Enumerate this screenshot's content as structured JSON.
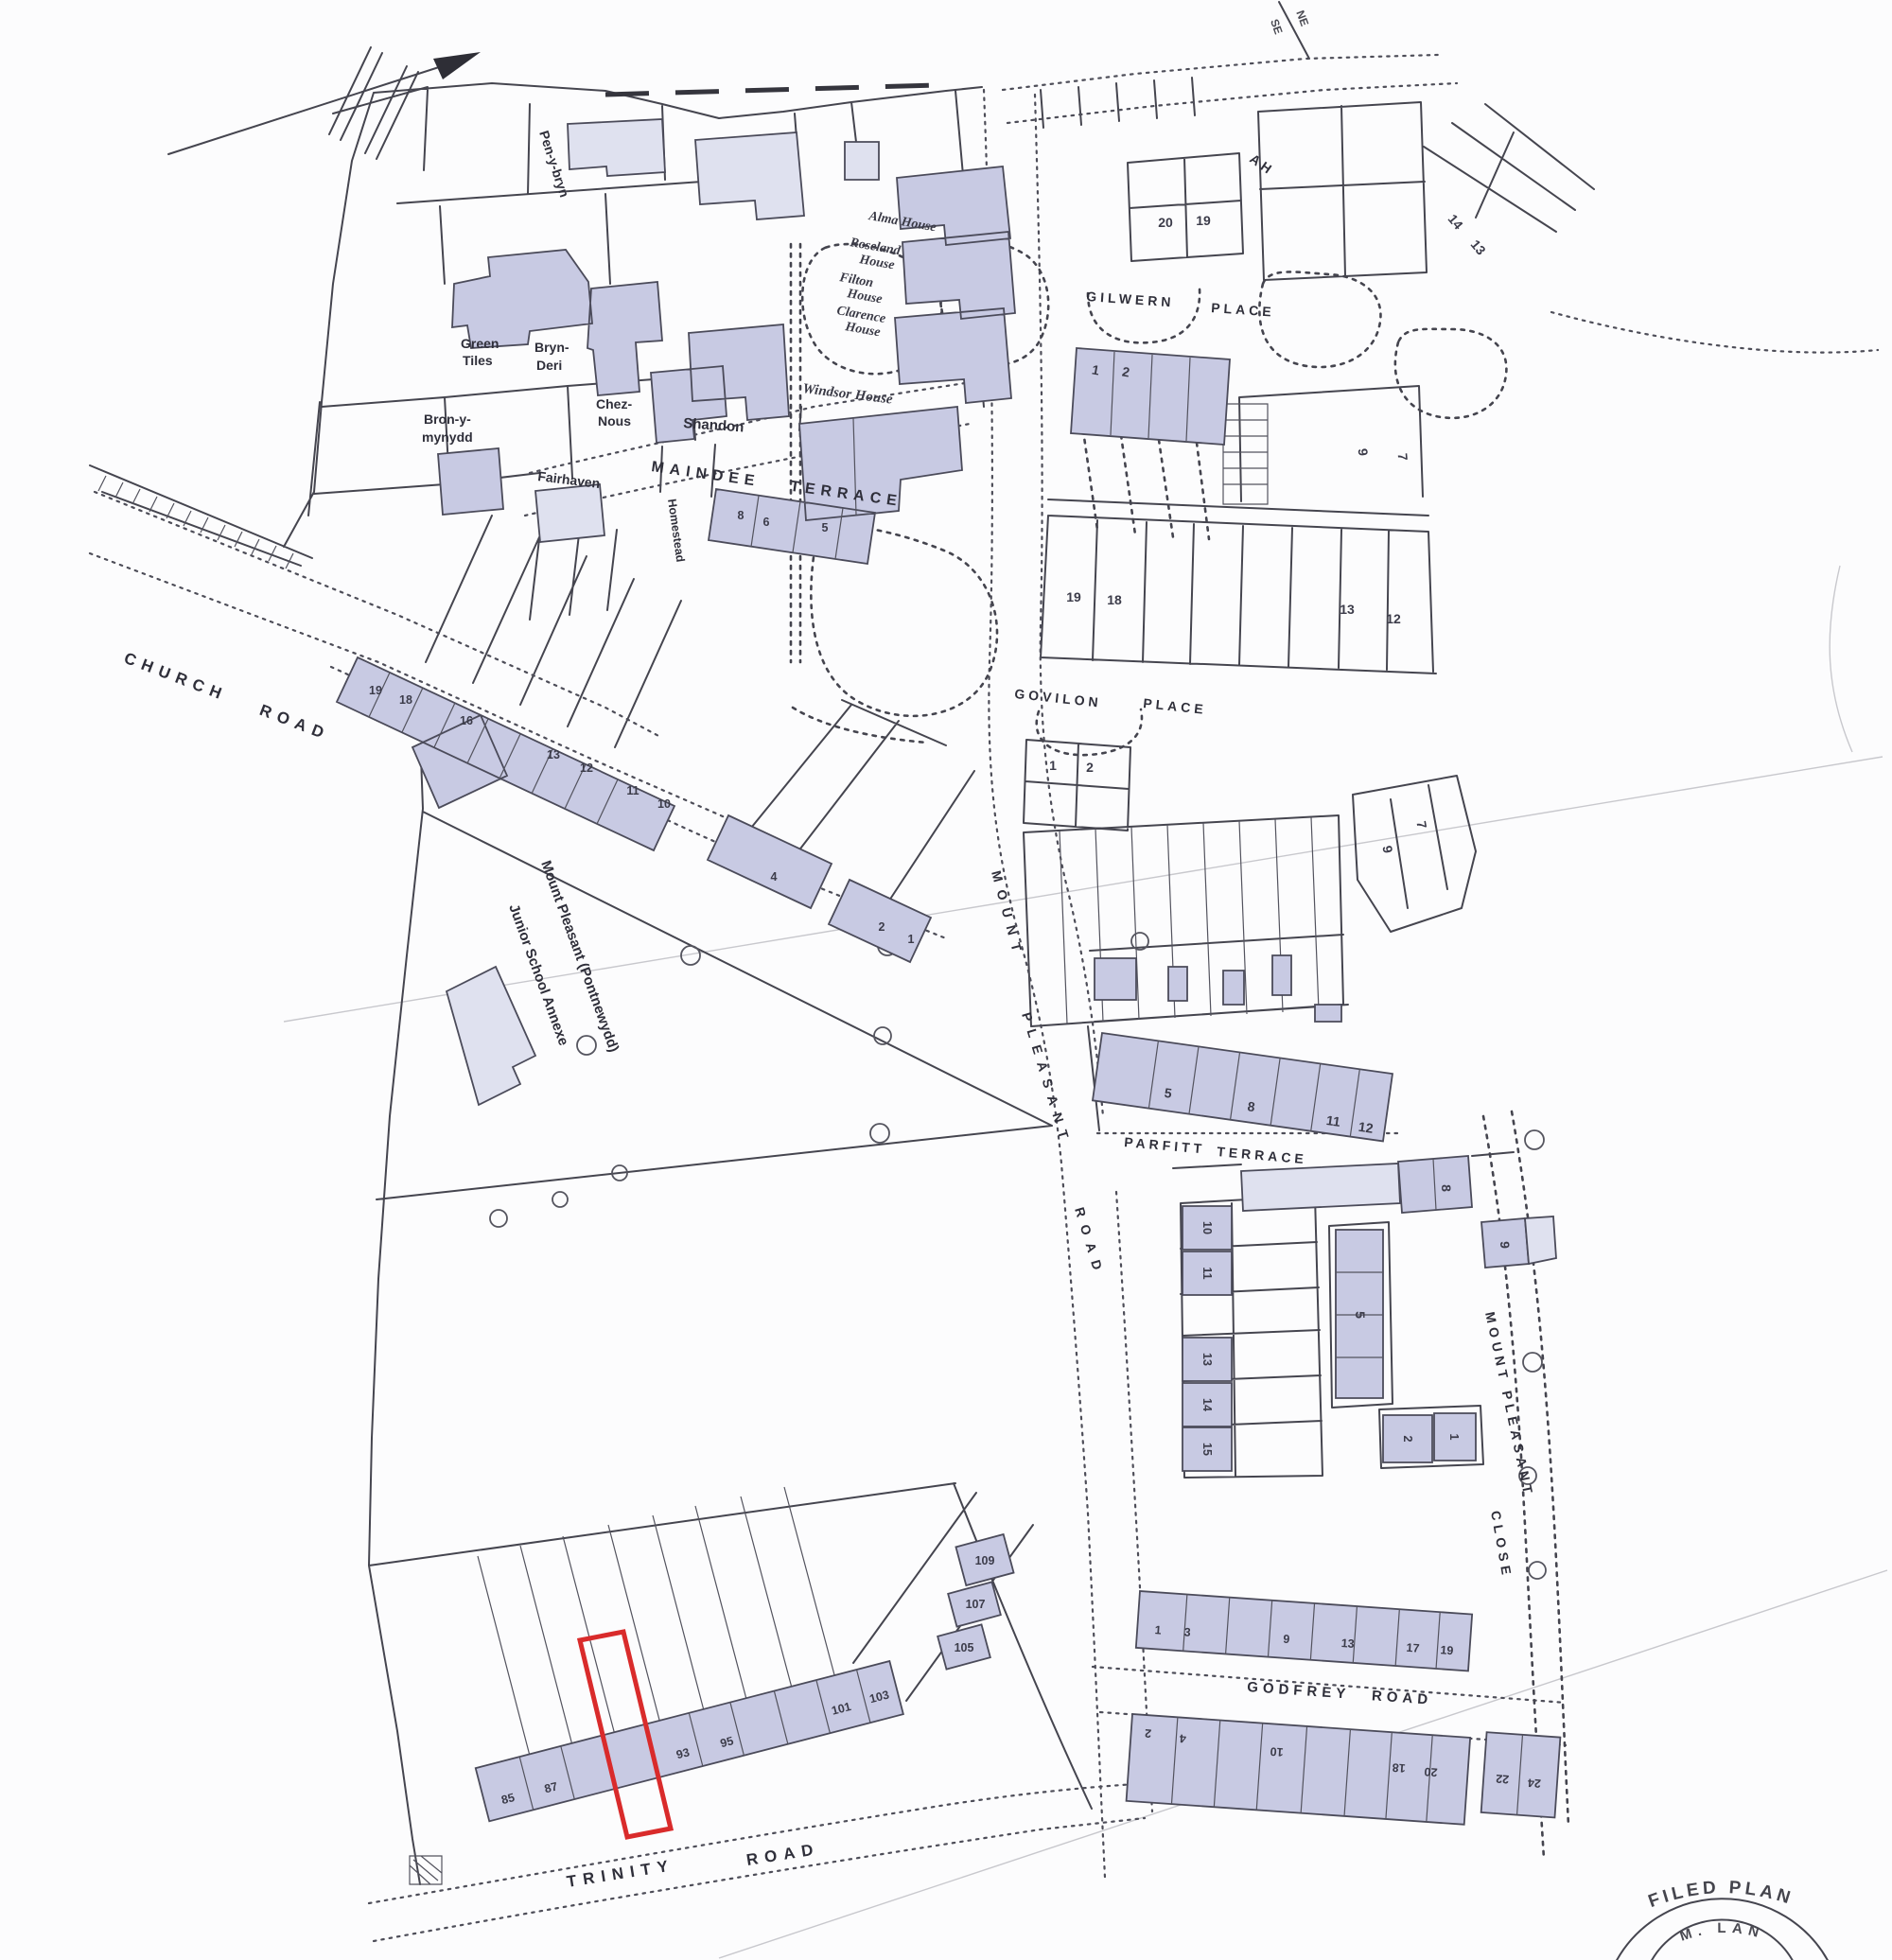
{
  "streets": {
    "church_road": "CHURCH ROAD",
    "maindee_terrace": "MAINDEE TERRACE",
    "mount_pleasant_road": [
      "MOUNT",
      "PLEASANT",
      "ROAD"
    ],
    "gilwern_place": [
      "GILWERN",
      "PLACE"
    ],
    "govilon_place": [
      "GOVILON",
      "PLACE"
    ],
    "parfitt_terrace": [
      "PARFITT",
      "TERRACE"
    ],
    "godfrey_road": "GODFREY ROAD",
    "trinity_road": [
      "TRINITY",
      "ROAD"
    ],
    "mount_pleasant_close": [
      "MOUNT PLEASANT",
      "CLOSE"
    ],
    "partial_top": "AH"
  },
  "houses": {
    "pen_y_bryn": "Pen-y-bryn",
    "green_tiles": [
      "Green",
      "Tiles"
    ],
    "bryn_deri": [
      "Bryn-",
      "Deri"
    ],
    "chez_nous": [
      "Chez-",
      "Nous"
    ],
    "shandon": "Shandon",
    "bron_y_mynydd": [
      "Bron-y-",
      "mynydd"
    ],
    "fairhaven": "Fairhaven",
    "homestead": "Homestead",
    "alma_house": "Alma House",
    "roseland_house": [
      "Roseland",
      "House"
    ],
    "filton_house": [
      "Filton",
      "House"
    ],
    "clarence_house": [
      "Clarence",
      "House"
    ],
    "windsor_house": "Windsor House"
  },
  "school": [
    "Mount Pleasant (Pontnewydd)",
    "Junior School Annexe"
  ],
  "plots": {
    "gilwern_block": [
      "20",
      "19"
    ],
    "gilwern_diagonal": [
      "14",
      "13"
    ],
    "gilwern_terrace": [
      "1",
      "2"
    ],
    "gilwern_east": [
      "9",
      "7"
    ],
    "gilwern_south_west": [
      "19",
      "18"
    ],
    "gilwern_south_east": [
      "13",
      "12"
    ],
    "govilon_terrace": [
      "1",
      "2"
    ],
    "govilon_east": [
      "9",
      "7"
    ],
    "church_road_terrace": [
      "19",
      "18",
      "16",
      "13",
      "12",
      "11",
      "10"
    ],
    "church_road_lower": [
      "4",
      "2",
      "1"
    ],
    "maindee_row": [
      "8",
      "6",
      "5"
    ],
    "parfitt_terrace": [
      "5",
      "8",
      "11",
      "12"
    ],
    "close_north": [
      "8",
      "9"
    ],
    "close_column": [
      "10",
      "11",
      "13",
      "14",
      "15"
    ],
    "close_middle": [
      "5"
    ],
    "close_south_pair": [
      "2",
      "1"
    ],
    "godfrey_north": [
      "1",
      "3",
      "9",
      "13",
      "17",
      "19"
    ],
    "godfrey_south": [
      "2",
      "4",
      "10",
      "18",
      "20",
      "22",
      "24"
    ],
    "trinity_terrace": [
      "85",
      "87",
      "93",
      "95",
      "101",
      "103"
    ],
    "trinity_detached": [
      "105",
      "107",
      "109"
    ]
  },
  "corner_marker": {
    "ne": "NE",
    "se": "SE"
  },
  "stamp": {
    "filed_plan": "FILED PLAN",
    "registry": "M. LAN"
  },
  "colors": {
    "building_fill": "#c8cae3",
    "building_light": "#dfe1ef",
    "line": "#45454f",
    "red_plot_outline": "#d92b2b",
    "paper": "#fcfcfd"
  }
}
